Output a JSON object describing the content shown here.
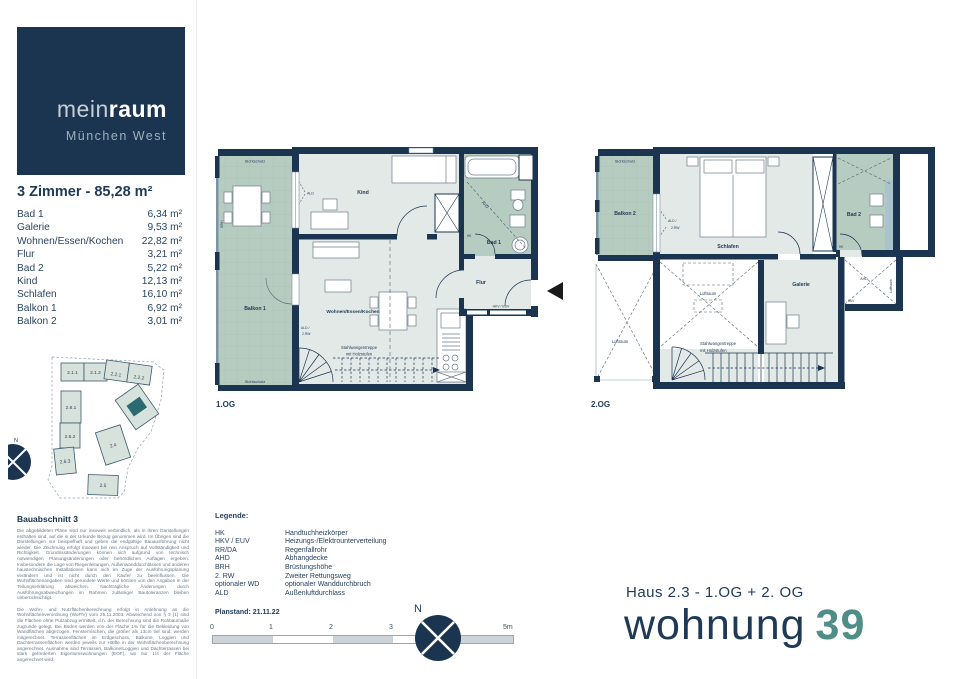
{
  "logo": {
    "brand_light": "mein",
    "brand_bold": "raum",
    "subtitle": "München West"
  },
  "summary": {
    "title": "3 Zimmer - 85,28 m²"
  },
  "rooms": [
    {
      "name": "Bad 1",
      "area": "6,34 m²"
    },
    {
      "name": "Galerie",
      "area": "9,53 m²"
    },
    {
      "name": "Wohnen/Essen/Kochen",
      "area": "22,82 m²"
    },
    {
      "name": "Flur",
      "area": "3,21 m²"
    },
    {
      "name": "Bad 2",
      "area": "5,22 m²"
    },
    {
      "name": "Kind",
      "area": "12,13 m²"
    },
    {
      "name": "Schlafen",
      "area": "16,10 m²"
    },
    {
      "name": "Balkon 1",
      "area": "6,92 m²"
    },
    {
      "name": "Balkon 2",
      "area": "3,01 m²"
    }
  ],
  "site": {
    "title": "Bauabschnitt 3",
    "buildings": [
      "2.1.1",
      "2.1.2",
      "2.2.1",
      "2.2.2",
      "2.6.1",
      "2.6.2",
      "2.6.3",
      "2.4",
      "2.5"
    ],
    "compass_n": "N"
  },
  "disclaimer": {
    "para1": "Die abgebildeten Pläne sind nur insoweit verbindlich, als in ihren Darstellungen enthalten sind, auf die in der Urkunde Bezug genommen wird. Im Übrigen sind die Darstellungen nur beispielhaft und geben die endgültige Bauausführung nicht wieder. Die Zeichnung erfolgt insoweit bei rein Anspruch auf Vollständigkeit und Richtigkeit. Grundrissänderungen können sich aufgrund von technisch notwendigen Planungsänderungen oder behördlichen Auflagen ergeben. Insbesondere die Lage von Riegenleitungen, Außenwanddurchlässen und anderen haustechnischen Installationen kann sich im Zuge der Ausführungsplanung verändern und ist nicht durch den Käufer zu beeinflussen. Die Wohnflächenangaben sind gerundete Werte und können von den Angaben in der Teilungserklärung abweichen. Nachträgliche Änderungen durch Ausführungsabweichungen im Rahmen zulässiger Bautoleranzen bleiben unberücksichtigt.",
    "para2": "Die Wohn- und Nutzflächenberechnung erfolgt in Anlehnung an die Wohnflächenverordnung (WoFlV) vom 25.11.2003. Abweichend von § 3 (1) sind die Flächen ohne Putzabzug ermittelt, d.h. der Berechnung sind die Rohbaumaße zugrunde gelegt. Bei Böden werden von der Fläche 1% für die Bekleidung von Wandflächen abgezogen. Fensternischen, die größer als 13cm tief sind, werden mitgerechnet. Terrassenflächen im Erdgeschoss, Balkone, Loggien und Dachterrassenflächen werden jeweils zur Hälfte in der Wohnflächenberechnung angerechnet. Ausnahme sind Terrassen, Balkone/Loggien und Dachterrassen bei stark geförderten Eigentumswohnungen (EOF), wo nur 1/4 der Fläche angerechnet wird."
  },
  "legend": {
    "title": "Legende:",
    "items": [
      {
        "abbr": "HK",
        "desc": "Handtuchheizkörper"
      },
      {
        "abbr": "HKV / EUV",
        "desc": "Heizungs-/Elektrounterverteilung"
      },
      {
        "abbr": "RR/DA",
        "desc": "Regenfallrohr"
      },
      {
        "abbr": "AHD",
        "desc": "Abhangdecke"
      },
      {
        "abbr": "BRH",
        "desc": "Brüstungshöhe"
      },
      {
        "abbr": "2. RW",
        "desc": "Zweiter Rettungsweg"
      },
      {
        "abbr": "optionaler WD",
        "desc": "optionaler Wanddurchbruch"
      },
      {
        "abbr": "ALD",
        "desc": "Außenluftdurchlass"
      }
    ]
  },
  "plan_meta": {
    "planstand": "Planstand: 21.11.22",
    "floor1": "1.OG",
    "floor2": "2.OG"
  },
  "scale": {
    "ticks": [
      "0",
      "1",
      "2",
      "3",
      "4",
      "5m"
    ]
  },
  "compass": {
    "n": "N"
  },
  "footer": {
    "haus_line": "Haus 2.3 - 1.OG + 2. OG",
    "wohnung_word": "wohnung",
    "wohnung_number": "39"
  },
  "plan1": {
    "labels": {
      "sichtschutz": "Sichtschutz",
      "balkon": "Balkon 1",
      "brh": "BRH",
      "ald": "ALD",
      "kind": "Kind",
      "bad": "Bad 1",
      "ahd": "AHD",
      "hk": "HK",
      "flur": "Flur",
      "hkv_euv": "HKV / EUV",
      "wohnen": "Wohnen/Essen/Kochen",
      "ald_rw1": "ALD /",
      "ald_rw2": "2.RW",
      "stairs1": "Stahlwangentreppe",
      "stairs2": "mit Holzstufen"
    }
  },
  "plan2": {
    "labels": {
      "sichtschutz": "Sichtschutz",
      "balkon": "Balkon 2",
      "ald_rw1": "ALD /",
      "ald_rw2": "2.RW",
      "schlafen": "Schlafen",
      "bad": "Bad 2",
      "hk": "HK",
      "luftraum": "Luftraum",
      "galerie": "Galerie",
      "ahd": "AHD",
      "hkv": "HKV",
      "stairs1": "Stahlwangentreppe",
      "stairs2": "mit Holzstufen"
    }
  }
}
